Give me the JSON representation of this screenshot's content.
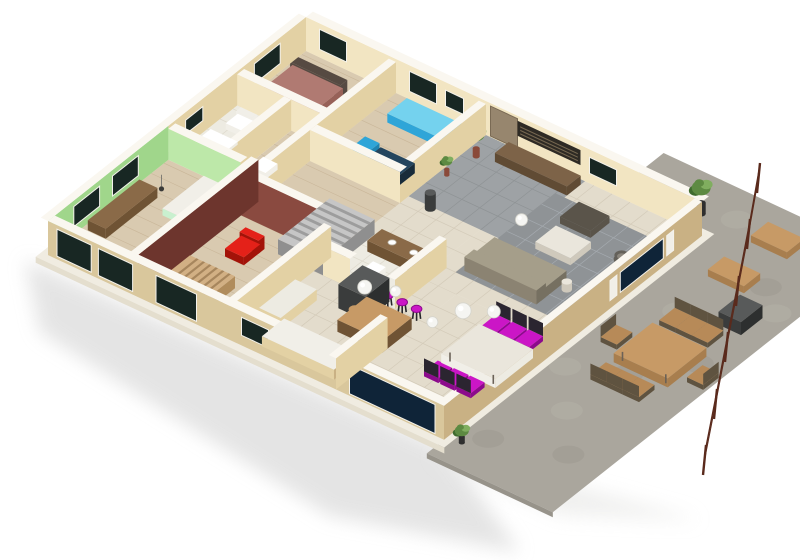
{
  "meta": {
    "kind": "3d-isometric-floor-plan-render",
    "canvas_width": 800,
    "canvas_height": 560
  },
  "palette": {
    "white": "#ffffff",
    "offWhite": "#f1efe8",
    "wallTop": "#faf7f0",
    "creamLit": "#f2e5c2",
    "creamShade": "#e3d1a4",
    "facade": "#d9c79c",
    "facadeShade": "#c9b184",
    "greenLit": "#bde8a9",
    "greenShade": "#a0d68b",
    "maroonLit": "#8a4a40",
    "maroonShade": "#6d352d",
    "woodFloor": "#d9cab0",
    "woodLine": "#c6b294",
    "tileBeige": "#e3dccc",
    "tileGrout": "#d2c9b7",
    "tileWhite": "#edebe2",
    "tileWhiteGrout": "#dbd7ca",
    "entryGray": "#9ea2a5",
    "entryGrayGrout": "#8d9194",
    "grayRug": "#8f9396",
    "rugGrout": "#a7adb2",
    "concrete": "#aaa69d",
    "concreteLight": "#bab6ad",
    "concreteDark": "#97938a",
    "slabEdge": "#f0ece1",
    "slabSide": "#e4dece",
    "shadow": "#dcdcdc",
    "windowDark": "#182723",
    "windowNavy": "#0f2438",
    "doorTan": "#97866e",
    "magenta": "#cb16c6",
    "magentaDark": "#8c0a8c",
    "red": "#e42119",
    "redDark": "#a31309",
    "blue": "#2fa5d8",
    "blueLight": "#74d2ee",
    "blueDark": "#1f84b2",
    "taupeTop": "#a59e8a",
    "taupeFront": "#8b8372",
    "taupeSide": "#767061",
    "darkChair": "#2b2530",
    "fridgeTop": "#585a5a",
    "fridgeFront": "#3a3c3c",
    "fridgeSide": "#2d2f2f",
    "brownTop": "#8a6a48",
    "brownFront": "#6f5334",
    "benchTop": "#7d6348",
    "benchFront": "#604b34",
    "artDark": "#2e2a24",
    "artSlat": "#756750",
    "terraceWood": "#c79a66",
    "terraceWoodDark": "#a87e4e",
    "chairWood": "#b78a58",
    "chairSlat": "#5f5340",
    "railing": "#5a2a1c",
    "plantDark": "#3f6b2e",
    "plant": "#5d8a42",
    "plantLight": "#80ae5f",
    "potDark": "#2f2f2f",
    "potRed": "#8a4a3a",
    "stairGray": "#c6c6c6",
    "stairGrayDark": "#8f8f8f",
    "stairStep": "#7c7c7c",
    "stairWoodTop": "#d2b084",
    "stairWoodFront": "#b08c5c",
    "stairWoodStep": "#8a6a42",
    "mauveTop": "#b07a72",
    "mauveFront": "#976158",
    "headboard": "#564a42",
    "mint": "#c9f0cf",
    "lampWhite": "#f5f5f2",
    "steel": "#c3c8c9",
    "steelLight": "#e9eded",
    "ottoman": "#5a544a",
    "coffeeTop": "#eae6dc",
    "coffeeFront": "#cfc9bc",
    "tubOuter": "#64615a",
    "tubInner": "#8a857c",
    "deskNavyTop": "#24455e",
    "deskNavyFront": "#182c3a",
    "rattan": "#97a550",
    "hob": "#3a3a3a",
    "cord": "#9a9a96"
  },
  "scene": {
    "rooms": [
      {
        "id": "green-bedroom",
        "floor": "wood",
        "walls": "green"
      },
      {
        "id": "bathroom",
        "floor": "white-tile",
        "walls": "cream"
      },
      {
        "id": "bedroom-2",
        "floor": "wood",
        "walls": "cream"
      },
      {
        "id": "hallway",
        "floor": "wood",
        "walls": "cream"
      },
      {
        "id": "office-den",
        "floor": "wood",
        "walls": "cream"
      },
      {
        "id": "maroon-lounge",
        "floor": "wood",
        "walls": "maroon"
      },
      {
        "id": "bathroom-2",
        "floor": "white-tile",
        "walls": "cream"
      },
      {
        "id": "kitchen",
        "floor": "beige-tile",
        "walls": "cream"
      },
      {
        "id": "dining-area",
        "floor": "beige-tile",
        "walls": "cream"
      },
      {
        "id": "living-room",
        "floor": "beige-tile-with-gray-rug",
        "walls": "cream"
      },
      {
        "id": "entry-hall",
        "floor": "gray-tile",
        "walls": "cream"
      },
      {
        "id": "terrace",
        "floor": "concrete",
        "walls": "none"
      }
    ],
    "furniture": [
      "desk",
      "mint-bed",
      "mauve-bed",
      "blue-sofa",
      "dark-desk",
      "blue-chair",
      "shower-tray",
      "toilets",
      "wood-stairs",
      "upper-stairs",
      "red-armchair",
      "red-chair",
      "vanity-two-sinks",
      "fridge",
      "kitchen-counter",
      "kitchen-sink",
      "cooktop",
      "bar-counter",
      "bar-stools",
      "dining-table",
      "dining-chairs",
      "pendant-lamps",
      "sofa",
      "coffee-table",
      "ottoman",
      "tub-chairs",
      "side-table",
      "sideboard-bench",
      "slatted-wall-art",
      "entry-door",
      "water-heater",
      "potted-plants",
      "terrace-table",
      "terrace-chairs",
      "terrace-bench",
      "bbq-grill",
      "railing"
    ],
    "counts": {
      "bar_stools": 3,
      "dining_chairs": 6,
      "terrace_chairs": 8,
      "railing_posts": 6,
      "pendant_lamps": 6,
      "vanity_sinks": 2
    }
  }
}
